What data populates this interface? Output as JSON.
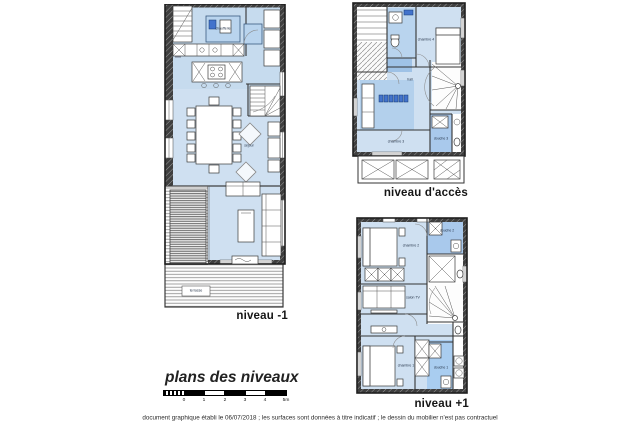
{
  "document": {
    "title": "plans des niveaux",
    "footer": "document graphique établi le 06/07/2018 ; les surfaces sont données à titre indicatif ; le dessin du mobilier n'est pas contractuel"
  },
  "scale_bar": {
    "unit_ticks": [
      "0",
      "1",
      "2",
      "3",
      "4",
      "5m"
    ]
  },
  "plans": {
    "level_minus1": {
      "label": "niveau -1",
      "rooms": {
        "chaufferie": "chaufferie",
        "sejour": "séjour",
        "terrasse": "terrasse"
      }
    },
    "level_access": {
      "label": "niveau d'accès",
      "rooms": {
        "hall": "hall",
        "chambre4": "chambre 4",
        "chambre3": "chambre 3",
        "douche3": "douche 3"
      }
    },
    "level_plus1": {
      "label": "niveau +1",
      "rooms": {
        "chambre2": "chambre 2",
        "douche2": "douche 2",
        "salon_tv": "salon TV",
        "chambre1": "chambre 1",
        "douche1": "douche 1"
      }
    }
  },
  "colors": {
    "room_light": "#cfe0f1",
    "room_medium": "#b9d4ee",
    "room_dark": "#a9c9ec",
    "accent_blue": "#4273cc",
    "wall": "#3f3f3f"
  }
}
